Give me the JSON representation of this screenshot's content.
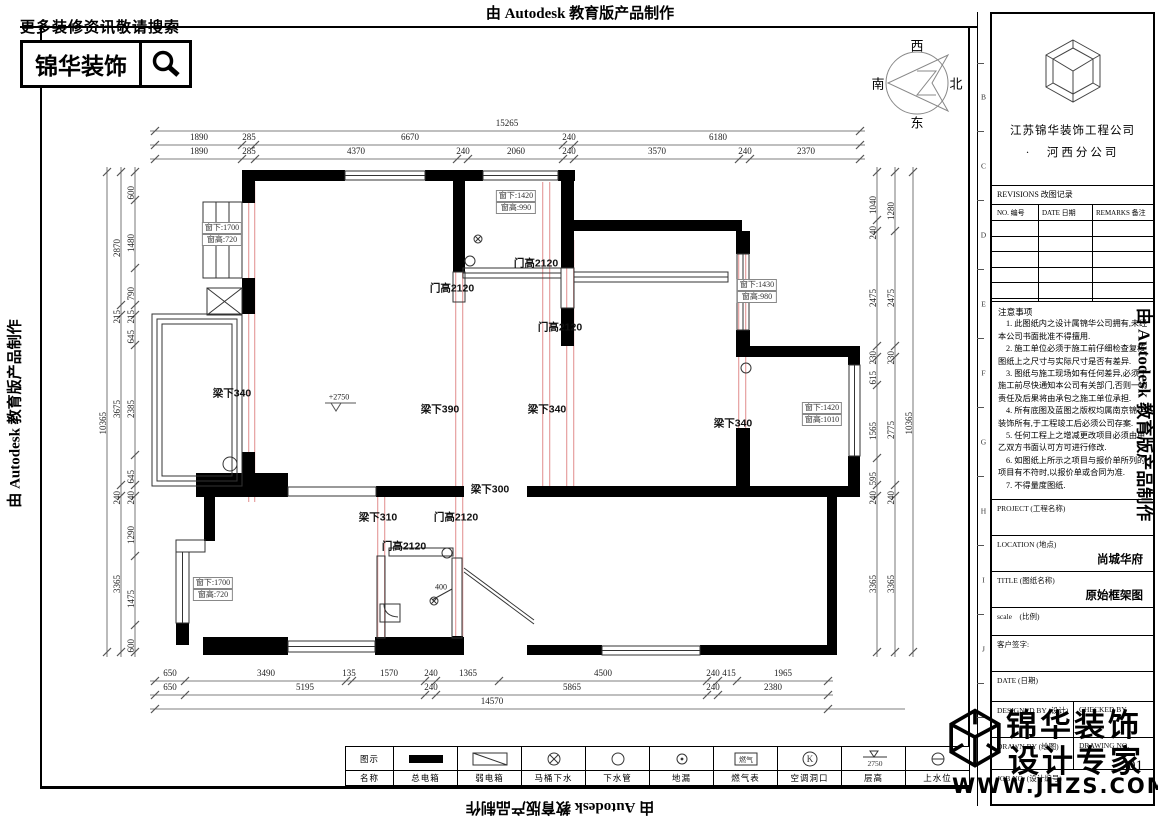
{
  "edge": {
    "top": "由 Autodesk 教育版产品制作",
    "left": "由 Autodesk 教育版产品制作",
    "right": "由 Autodesk 教育版产品制作",
    "bottom": "由 Autodesk 教育版产品制作"
  },
  "search_banner": {
    "tagline": "更多装修资讯敬请搜索",
    "brand": "锦华装饰"
  },
  "compass": {
    "west": "西",
    "south": "南",
    "north": "北",
    "east": "东"
  },
  "grid_letters": [
    "B",
    "C",
    "D",
    "E",
    "F",
    "G",
    "H",
    "I",
    "J"
  ],
  "title_block": {
    "company_line1": "江苏锦华装饰工程公司",
    "company_line2": "·　河西分公司",
    "revisions_title": "REVISIONS 改图记录",
    "revisions_columns": [
      "NO. 编号",
      "DATE 日期",
      "REMARKS 备注"
    ],
    "notes_title": "注意事项",
    "notes": [
      "1. 此图纸内之设计属锦华公司拥有,未经本公司书面批准不得擅用.",
      "2. 施工单位必须于施工前仔细检查复核图纸上之尺寸与实际尺寸是否有差异.",
      "3. 图纸与施工现场如有任何差异,必须于施工前尽快通知本公司有关部门,否则一切责任及后果将由承包之施工单位承担.",
      "4. 所有底图及蓝图之版权均属南京锦华装饰所有,于工程竣工后必须公司存案.",
      "5. 任何工程上之增减更改项目必须由甲乙双方书面认可方可进行修改.",
      "6. 如图纸上所示之项目与报价单所列的项目有不符时,以报价单或合同为准.",
      "7. 不得量度图纸."
    ],
    "project_label": "PROJECT (工程名称)",
    "location_label": "LOCATION (地点)",
    "location_value": "尚城华府",
    "title_label": "TITLE (图纸名称)",
    "title_value": "原始框架图",
    "scale_label": "scale　(比例)",
    "signature_label": "客户签字:",
    "date_label": "DATE (日期)",
    "designed_label": "DESIGNED BY (设计)",
    "checked_label": "CHECKED BY",
    "drawn_label": "DRAWN BY (绘图)",
    "drawing_no_label": "DRAWING NO.",
    "job_no_label": "JOB NO. (设计编号)",
    "drawing_number": "01"
  },
  "stamp": {
    "line1": "锦华装饰",
    "line2": "设计专家",
    "website": "WWW.JHZS.COM"
  },
  "legend": {
    "row_symbol_label": "图示",
    "row_name_label": "名称",
    "items": [
      {
        "name": "总电箱",
        "symbol": "filled-rect"
      },
      {
        "name": "弱电箱",
        "symbol": "diagonal-rect"
      },
      {
        "name": "马桶下水",
        "symbol": "circle-cross"
      },
      {
        "name": "下水管",
        "symbol": "circle"
      },
      {
        "name": "地漏",
        "symbol": "circle-dot"
      },
      {
        "name": "燃气表",
        "symbol": "gas-box",
        "symbol_text": "燃气"
      },
      {
        "name": "空调洞口",
        "symbol": "circle-k",
        "symbol_text": "K"
      },
      {
        "name": "层高",
        "symbol": "level-triangle",
        "symbol_text": "2750"
      },
      {
        "name": "上水位",
        "symbol": "circle-dash"
      }
    ]
  },
  "plan": {
    "level_mark": "+2750",
    "dim_labels": [
      {
        "t": "15265",
        "x": 507,
        "y": 128,
        "v": 0
      },
      {
        "t": "1890",
        "x": 199,
        "y": 142,
        "v": 0
      },
      {
        "t": "285",
        "x": 249,
        "y": 142,
        "v": 0
      },
      {
        "t": "6670",
        "x": 410,
        "y": 142,
        "v": 0
      },
      {
        "t": "240",
        "x": 569,
        "y": 142,
        "v": 0
      },
      {
        "t": "6180",
        "x": 718,
        "y": 142,
        "v": 0
      },
      {
        "t": "1890",
        "x": 199,
        "y": 156,
        "v": 0
      },
      {
        "t": "285",
        "x": 249,
        "y": 156,
        "v": 0
      },
      {
        "t": "4370",
        "x": 356,
        "y": 156,
        "v": 0
      },
      {
        "t": "240",
        "x": 463,
        "y": 156,
        "v": 0
      },
      {
        "t": "2060",
        "x": 516,
        "y": 156,
        "v": 0
      },
      {
        "t": "240",
        "x": 569,
        "y": 156,
        "v": 0
      },
      {
        "t": "3570",
        "x": 657,
        "y": 156,
        "v": 0
      },
      {
        "t": "240",
        "x": 745,
        "y": 156,
        "v": 0
      },
      {
        "t": "2370",
        "x": 806,
        "y": 156,
        "v": 0
      },
      {
        "t": "650",
        "x": 170,
        "y": 678,
        "v": 0
      },
      {
        "t": "3490",
        "x": 266,
        "y": 678,
        "v": 0
      },
      {
        "t": "135",
        "x": 349,
        "y": 678,
        "v": 0
      },
      {
        "t": "1570",
        "x": 389,
        "y": 678,
        "v": 0
      },
      {
        "t": "240",
        "x": 431,
        "y": 678,
        "v": 0
      },
      {
        "t": "1365",
        "x": 468,
        "y": 678,
        "v": 0
      },
      {
        "t": "4500",
        "x": 603,
        "y": 678,
        "v": 0
      },
      {
        "t": "240",
        "x": 713,
        "y": 678,
        "v": 0
      },
      {
        "t": "415",
        "x": 729,
        "y": 678,
        "v": 0
      },
      {
        "t": "1965",
        "x": 783,
        "y": 678,
        "v": 0
      },
      {
        "t": "650",
        "x": 170,
        "y": 692,
        "v": 0
      },
      {
        "t": "5195",
        "x": 305,
        "y": 692,
        "v": 0
      },
      {
        "t": "240",
        "x": 431,
        "y": 692,
        "v": 0
      },
      {
        "t": "5865",
        "x": 572,
        "y": 692,
        "v": 0
      },
      {
        "t": "240",
        "x": 713,
        "y": 692,
        "v": 0
      },
      {
        "t": "2380",
        "x": 773,
        "y": 692,
        "v": 0
      },
      {
        "t": "14570",
        "x": 492,
        "y": 706,
        "v": 0
      },
      {
        "t": "600",
        "x": 131,
        "y": 186,
        "v": 1
      },
      {
        "t": "1480",
        "x": 131,
        "y": 234,
        "v": 1
      },
      {
        "t": "790",
        "x": 131,
        "y": 287,
        "v": 1
      },
      {
        "t": "215",
        "x": 131,
        "y": 310,
        "v": 1
      },
      {
        "t": "645",
        "x": 131,
        "y": 330,
        "v": 1
      },
      {
        "t": "2385",
        "x": 131,
        "y": 400,
        "v": 1
      },
      {
        "t": "645",
        "x": 131,
        "y": 470,
        "v": 1
      },
      {
        "t": "240",
        "x": 131,
        "y": 491,
        "v": 1
      },
      {
        "t": "1290",
        "x": 131,
        "y": 526,
        "v": 1
      },
      {
        "t": "1475",
        "x": 131,
        "y": 590,
        "v": 1
      },
      {
        "t": "600",
        "x": 131,
        "y": 639,
        "v": 1
      },
      {
        "t": "2870",
        "x": 117,
        "y": 239,
        "v": 1
      },
      {
        "t": "215",
        "x": 117,
        "y": 310,
        "v": 1
      },
      {
        "t": "3675",
        "x": 117,
        "y": 400,
        "v": 1
      },
      {
        "t": "240",
        "x": 117,
        "y": 491,
        "v": 1
      },
      {
        "t": "3365",
        "x": 117,
        "y": 575,
        "v": 1
      },
      {
        "t": "10365",
        "x": 103,
        "y": 412,
        "v": 1
      },
      {
        "t": "1040",
        "x": 873,
        "y": 196,
        "v": 1
      },
      {
        "t": "240",
        "x": 873,
        "y": 226,
        "v": 1
      },
      {
        "t": "2475",
        "x": 873,
        "y": 289,
        "v": 1
      },
      {
        "t": "230",
        "x": 873,
        "y": 351,
        "v": 1
      },
      {
        "t": "615",
        "x": 873,
        "y": 371,
        "v": 1
      },
      {
        "t": "1565",
        "x": 873,
        "y": 422,
        "v": 1
      },
      {
        "t": "595",
        "x": 873,
        "y": 472,
        "v": 1
      },
      {
        "t": "240",
        "x": 873,
        "y": 491,
        "v": 1
      },
      {
        "t": "3365",
        "x": 873,
        "y": 575,
        "v": 1
      },
      {
        "t": "1280",
        "x": 891,
        "y": 202,
        "v": 1
      },
      {
        "t": "2475",
        "x": 891,
        "y": 289,
        "v": 1
      },
      {
        "t": "230",
        "x": 891,
        "y": 351,
        "v": 1
      },
      {
        "t": "2775",
        "x": 891,
        "y": 421,
        "v": 1
      },
      {
        "t": "240",
        "x": 891,
        "y": 491,
        "v": 1
      },
      {
        "t": "3365",
        "x": 891,
        "y": 575,
        "v": 1
      },
      {
        "t": "10365",
        "x": 909,
        "y": 412,
        "v": 1
      }
    ],
    "beam_door_labels": [
      {
        "t": "门高2120",
        "x": 536,
        "y": 263
      },
      {
        "t": "门高2120",
        "x": 452,
        "y": 288
      },
      {
        "t": "门高2120",
        "x": 560,
        "y": 327
      },
      {
        "t": "梁下340",
        "x": 232,
        "y": 393
      },
      {
        "t": "梁下390",
        "x": 440,
        "y": 409
      },
      {
        "t": "梁下340",
        "x": 547,
        "y": 409
      },
      {
        "t": "梁下340",
        "x": 733,
        "y": 423
      },
      {
        "t": "梁下300",
        "x": 490,
        "y": 489
      },
      {
        "t": "梁下310",
        "x": 378,
        "y": 517
      },
      {
        "t": "门高2120",
        "x": 456,
        "y": 517
      },
      {
        "t": "门高2120",
        "x": 404,
        "y": 546
      }
    ],
    "small_labels": [
      {
        "t": "+2750",
        "x": 339,
        "y": 397
      },
      {
        "t": "400",
        "x": 441,
        "y": 587
      }
    ],
    "window_tags": [
      {
        "l1": "窗下:1700",
        "l2": "窗高:720",
        "x": 222,
        "y": 222
      },
      {
        "l1": "窗下:1420",
        "l2": "窗高:990",
        "x": 516,
        "y": 190
      },
      {
        "l1": "窗下:1430",
        "l2": "窗高:980",
        "x": 757,
        "y": 279
      },
      {
        "l1": "窗下:1420",
        "l2": "窗高:1010",
        "x": 822,
        "y": 402
      },
      {
        "l1": "窗下:1700",
        "l2": "窗高:720",
        "x": 213,
        "y": 577
      }
    ],
    "dim_lines": [
      {
        "o": "h",
        "p": 131,
        "a": 150,
        "b": 865,
        "t": [
          155,
          860
        ]
      },
      {
        "o": "h",
        "p": 145,
        "a": 150,
        "b": 865,
        "t": [
          155,
          242,
          255,
          563,
          574,
          860
        ]
      },
      {
        "o": "h",
        "p": 159,
        "a": 150,
        "b": 865,
        "t": [
          155,
          242,
          255,
          457,
          468,
          563,
          574,
          739,
          750,
          860
        ]
      },
      {
        "o": "h",
        "p": 681,
        "a": 150,
        "b": 833,
        "t": [
          155,
          185,
          346,
          352,
          425,
          436,
          499,
          707,
          718,
          737,
          828
        ]
      },
      {
        "o": "h",
        "p": 695,
        "a": 150,
        "b": 833,
        "t": [
          155,
          185,
          425,
          436,
          707,
          718,
          828
        ]
      },
      {
        "o": "h",
        "p": 709,
        "a": 150,
        "b": 905,
        "t": [
          155,
          828
        ]
      },
      {
        "o": "v",
        "p": 135,
        "a": 167,
        "b": 657,
        "t": [
          172,
          200,
          268,
          305,
          315,
          345,
          455,
          485,
          496,
          556,
          625,
          652
        ]
      },
      {
        "o": "v",
        "p": 121,
        "a": 167,
        "b": 657,
        "t": [
          172,
          305,
          315,
          485,
          496,
          652
        ]
      },
      {
        "o": "v",
        "p": 107,
        "a": 167,
        "b": 657,
        "t": [
          172,
          652
        ]
      },
      {
        "o": "v",
        "p": 877,
        "a": 167,
        "b": 657,
        "t": [
          172,
          220,
          231,
          346,
          357,
          385,
          458,
          485,
          496,
          652
        ]
      },
      {
        "o": "v",
        "p": 895,
        "a": 167,
        "b": 657,
        "t": [
          172,
          231,
          346,
          357,
          485,
          496,
          652
        ]
      },
      {
        "o": "v",
        "p": 913,
        "a": 167,
        "b": 657,
        "t": [
          172,
          652
        ]
      }
    ]
  }
}
